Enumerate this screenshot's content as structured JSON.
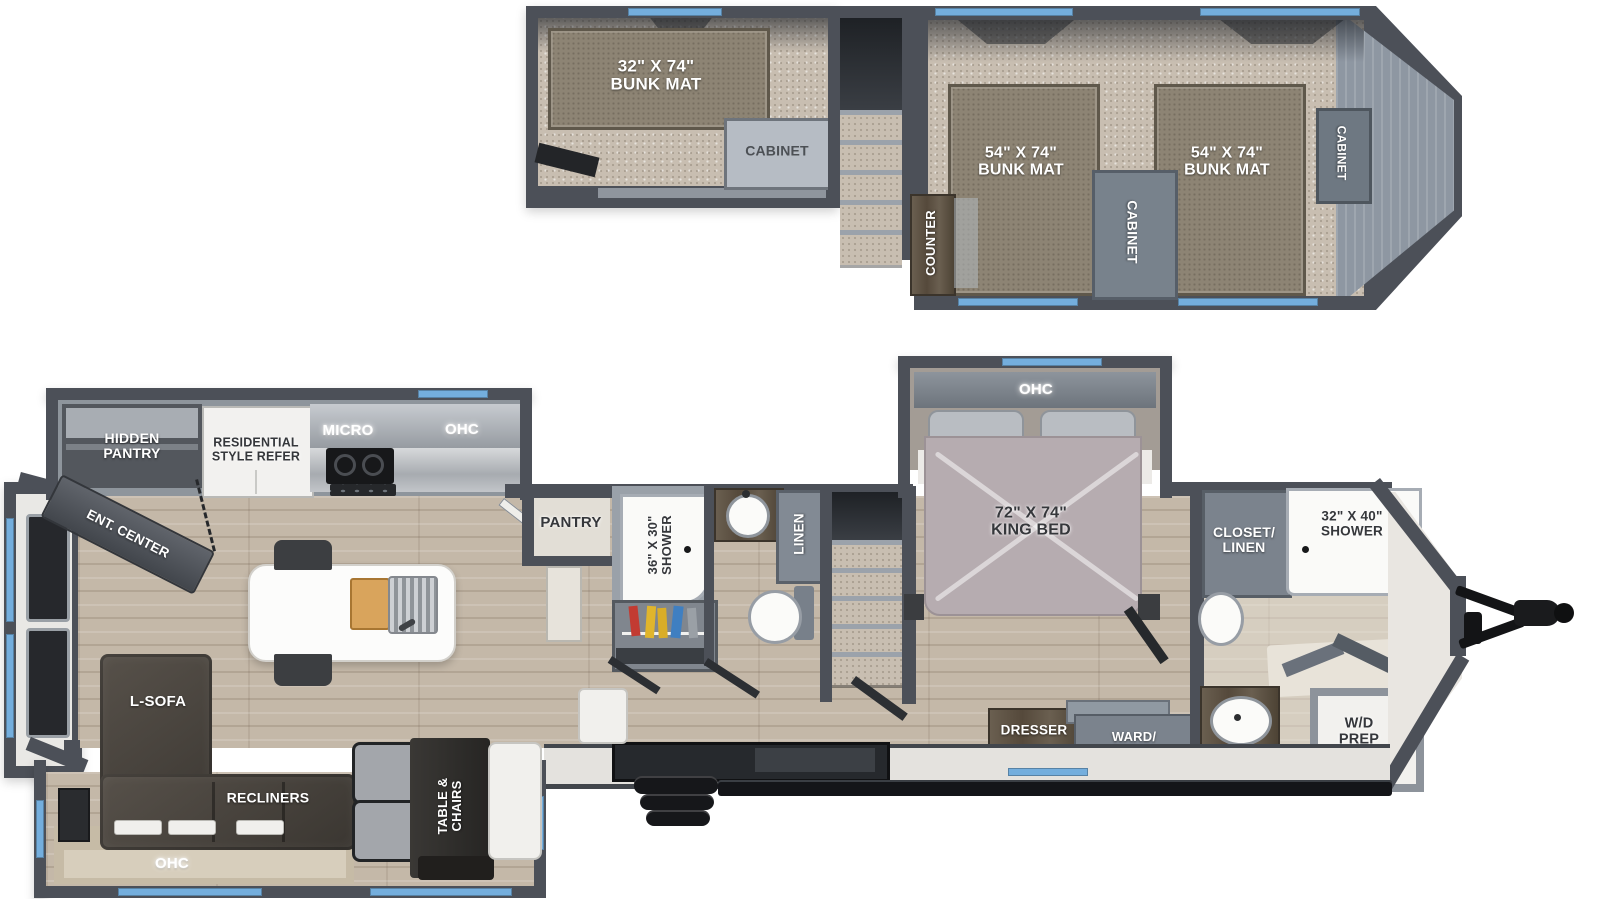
{
  "title": "Two-level RV travel trailer floor plan with loft",
  "colors": {
    "wall": "#4c5058",
    "window_accent": "#74aedd",
    "carpet": "#c8beb1",
    "wood_floor": "#c4b8a8",
    "bunk_mat": "#8d8474",
    "cabinet_gray": "#7b838d",
    "dark_furniture": "#3a3631"
  },
  "loft": {
    "bunk_left": "32\" X 74\"\nBUNK MAT",
    "cabinet_left": "CABINET",
    "counter": "COUNTER",
    "bunk_center": "54\" X 74\"\nBUNK MAT",
    "cabinet_center": "CABINET",
    "bunk_right": "54\" X 74\"\nBUNK MAT",
    "cabinet_right": "CABINET"
  },
  "main": {
    "hidden_pantry": "HIDDEN\nPANTRY",
    "refrigerator": "RESIDENTIAL\nSTYLE REFER",
    "micro": "MICRO",
    "kitchen_ohc": "OHC",
    "ent_center": "ENT. CENTER",
    "pantry": "PANTRY",
    "shower_mid": "36\" X 30\"\nSHOWER",
    "linen": "LINEN",
    "bedroom_ohc": "OHC",
    "king_bed": "72\" X 74\"\nKING BED",
    "closet_linen": "CLOSET/\nLINEN",
    "shower_front": "32\" X 40\"\nSHOWER",
    "dresser": "DRESSER",
    "ward_closet": "WARD/\nCLOSET",
    "med": "MED",
    "wd_prep": "W/D\nPREP",
    "l_sofa": "L-SOFA",
    "recliners": "RECLINERS",
    "living_ohc": "OHC",
    "table_chairs": "TABLE &\nCHAIRS"
  }
}
